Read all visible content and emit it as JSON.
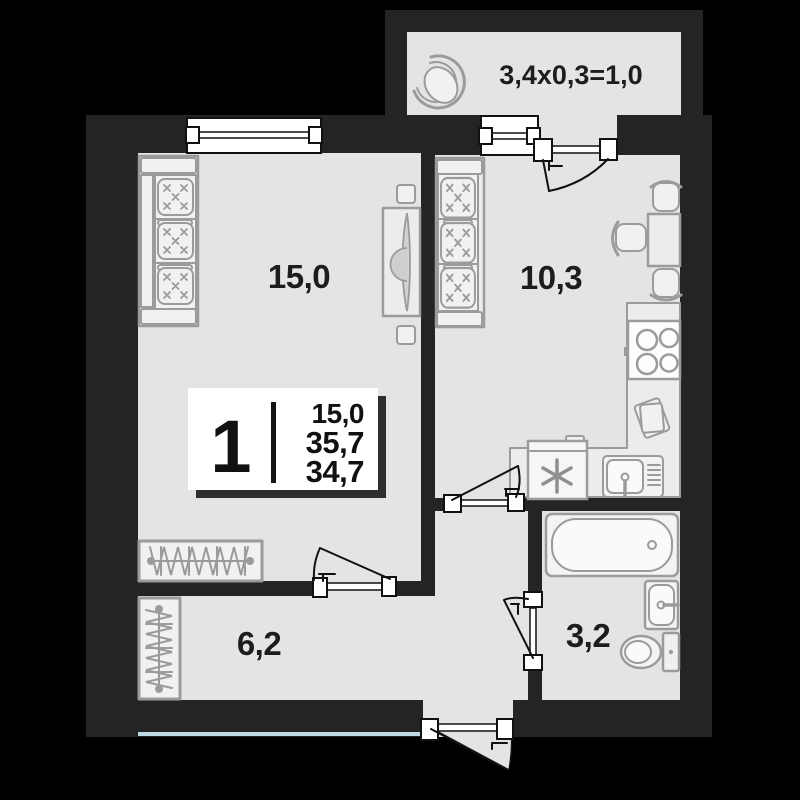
{
  "floor_plan": {
    "balcony": {
      "label": "3,4x0,3=1,0"
    },
    "rooms": {
      "living": {
        "label": "15,0"
      },
      "kitchen": {
        "label": "10,3"
      },
      "hallway": {
        "label": "6,2"
      },
      "bathroom": {
        "label": "3,2"
      }
    },
    "info_badge": {
      "room_count": "1",
      "living_area": "15,0",
      "total_area": "35,7",
      "reduced_area": "34,7"
    },
    "colors": {
      "background": "#000000",
      "wall": "#242424",
      "floor": "#e4e4e4",
      "window_fill": "#ffffff",
      "furniture_stroke": "#9b9b9b",
      "door_stroke": "#111111",
      "label_text": "#1d1d1d",
      "entry_accent_line": "#bcd9e4",
      "badge_background": "#ffffff",
      "badge_shadow": "#2f2f2f"
    },
    "furniture_icons": [
      "sofa-icon",
      "tv-stand-icon",
      "wardrobe-icon",
      "coat-rack-icon",
      "dining-table-icon",
      "chair-icon",
      "stove-icon",
      "fridge-icon",
      "kitchen-sink-icon",
      "cutting-board-icon",
      "bathtub-icon",
      "washbasin-icon",
      "toilet-icon",
      "air-conditioner-icon"
    ]
  }
}
